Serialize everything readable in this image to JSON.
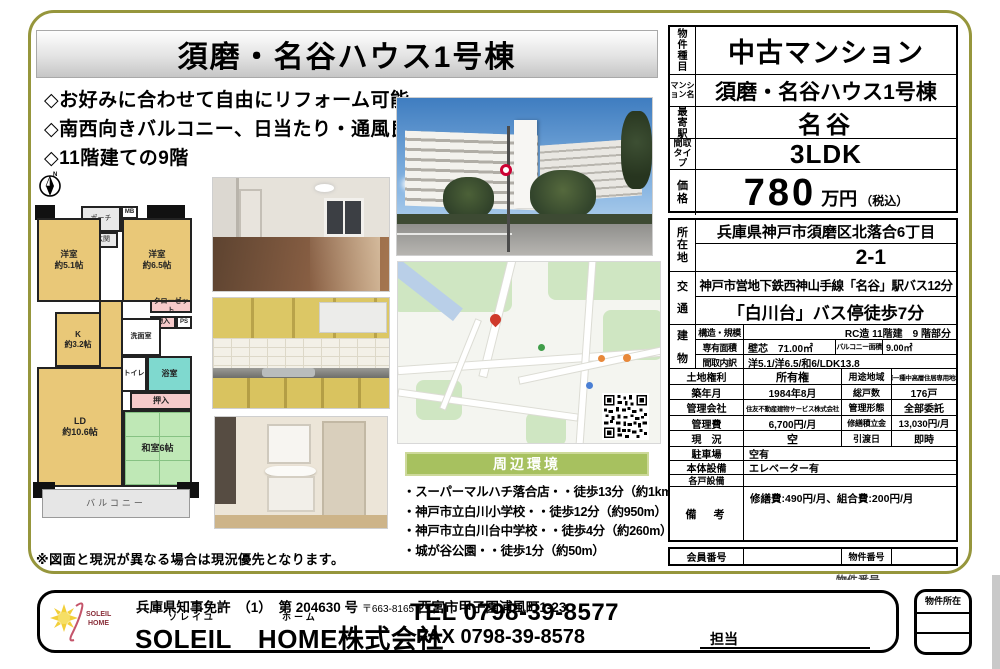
{
  "colors": {
    "border_olive": "#96963c",
    "surround_green": "#a7c15f",
    "room_tan": "#e9c878",
    "tatami_green": "#bfe8b6",
    "bath_cyan": "#7fd9cf",
    "closet_pink": "#f6caca",
    "sky_blue": "#4a86c8",
    "pin_red": "#cf3a2c"
  },
  "flyer": {
    "title": "須磨・名谷ハウス1号棟",
    "highlights": [
      "◇お好みに合わせて自由にリフォーム可能",
      "◇南西向きバルコニー、日当たり・通風良好",
      "◇11階建ての9階"
    ],
    "floorplan": {
      "compass": "N",
      "porch": "ポーチ",
      "mb": "MB",
      "ps": "PS",
      "entrance": "玄関",
      "western1": "洋室\n約5.1帖",
      "western2": "洋室\n約6.5帖",
      "closet": "クローゼット",
      "storage": "物入",
      "ps2": "PS",
      "kitchen": "K\n約3.2帖",
      "wash": "洗面室",
      "toilet": "トイレ",
      "bath": "浴室",
      "oshiire": "押入",
      "ld": "LD\n約10.6帖",
      "japanese": "和室6帖",
      "balcony": "バルコニー",
      "note": "※図面と現況が異なる場合は現況優先となります。"
    },
    "surroundings": {
      "header": "周辺環境",
      "items": [
        "・スーパーマルハチ落合店・・徒歩13分（約1km）",
        "・神戸市立白川小学校・・徒歩12分（約950m）",
        "・神戸市立白川台中学校・・徒歩4分（約260m）",
        "・城が谷公園・・徒歩1分（約50m）"
      ]
    },
    "table": {
      "type": {
        "label": "物件種目",
        "value": "中古マンション"
      },
      "name": {
        "label": "マンション名",
        "value": "須磨・名谷ハウス1号棟"
      },
      "station": {
        "label": "最寄駅",
        "value": "名谷"
      },
      "layout": {
        "label": "間取タイプ",
        "value": "3LDK"
      },
      "price": {
        "label": "価格",
        "value": "780",
        "unit": "万円",
        "tax": "（税込）"
      },
      "address": {
        "label": "所在地",
        "line1": "兵庫県神戸市須磨区北落合6丁目",
        "line2": "2-1"
      },
      "access": {
        "label": "交通",
        "line1": "神戸市営地下鉄西神山手線「名谷」駅バス12分",
        "line2": "「白川台」バス停徒歩7分"
      },
      "building": {
        "label": "建物",
        "structure": {
          "label": "構造・規模",
          "value": "RC造 11階建　9 階部分"
        },
        "area": {
          "label": "専有面積",
          "value": "壁芯　71.00㎡",
          "label2": "バルコニー面積",
          "value2": "9.00㎡"
        },
        "rooms": {
          "label": "間取内訳",
          "value": "洋5.1/洋6.5/和6/LDK13.8"
        }
      },
      "land": {
        "label": "土地権利",
        "value": "所有権",
        "label2": "用途地域",
        "value2": "第一種中高層住居専用地域"
      },
      "built": {
        "label": "築年月",
        "value": "1984年8月",
        "label2": "総戸数",
        "value2": "176戸"
      },
      "mgmtco": {
        "label": "管理会社",
        "value": "住友不動産建物サービス株式会社",
        "label2": "管理形態",
        "value2": "全部委託"
      },
      "fee": {
        "label": "管理費",
        "value": "6,700円/月",
        "label2": "修繕積立金",
        "value2": "13,030円/月"
      },
      "status": {
        "label": "現　況",
        "value": "空",
        "label2": "引渡日",
        "value2": "即時"
      },
      "parking": {
        "label": "駐車場",
        "value": "空有"
      },
      "equip": {
        "label": "本体設備",
        "value": "エレベーター有"
      },
      "unit_equip": {
        "label": "各戸設備",
        "value": ""
      },
      "notes": {
        "label": "備　考",
        "value": "修繕費:490円/月、組合費:200円/月"
      },
      "member": {
        "label": "会員番号",
        "value": "",
        "label2": "物件番号",
        "value2": ""
      }
    },
    "footer": {
      "license": "兵庫県知事免許　（1）　第 204630 号",
      "postal": "〒663-8165",
      "office_address": "西宮市甲子園浦風町1-23",
      "furigana1": "ソレイユ",
      "furigana2": "ホーム",
      "company": "SOLEIL　HOME株式会社",
      "logo_line1": "SOLEIL",
      "logo_line2": "HOME",
      "tel": "TEL 0798-39-8577",
      "fax": "FAX 0798-39-8578",
      "staff_label": "担当",
      "property_location_label": "物件所在",
      "clipped_property_no": "物件番号"
    }
  }
}
